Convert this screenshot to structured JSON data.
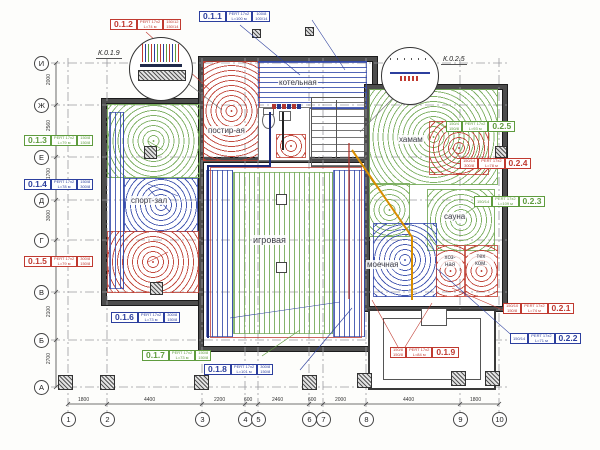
{
  "colors": {
    "red": "#c03a30",
    "blue": "#2c3f9e",
    "green": "#5f9c3e",
    "orange": "#d98e00",
    "wall": "#4d4d4d"
  },
  "grid": {
    "cols": [
      "1",
      "2",
      "3",
      "4",
      "5",
      "6",
      "7",
      "8",
      "9",
      "10"
    ],
    "col_dims": [
      "1800",
      "4400",
      "2200",
      "600",
      "2460",
      "600",
      "2000",
      "4400",
      "1800"
    ],
    "rows": [
      "И",
      "Ж",
      "Е",
      "Д",
      "Г",
      "В",
      "Б",
      "А"
    ],
    "row_dims": [
      "2000",
      "2560",
      "1700",
      "3000",
      "2000",
      "2100",
      "2700"
    ]
  },
  "callouts": {
    "left": "К.0.1.9",
    "right": "К.0.2.5"
  },
  "rooms": {
    "boiler": "котельная",
    "laundry": "постир-ая",
    "gym": "спорт-зал",
    "game": "игровая",
    "hammam": "хамам",
    "sauna": "сауна",
    "wash": "моечная",
    "hoz1": "хоз-",
    "hoz2": "ная",
    "tech1": "тех",
    "tech2": "ком."
  },
  "circuits": {
    "c011": {
      "id": "0.1.1",
      "pipe": "PERT 17x2",
      "len": "L=100 м",
      "v1": "100/8",
      "v2": "100/14"
    },
    "c012": {
      "id": "0.1.2",
      "pipe": "PERT 17x2",
      "len": "L=74 м",
      "v1": "150/12",
      "v2": "150/14"
    },
    "c013": {
      "id": "0.1.3",
      "pipe": "PERT 17x2",
      "len": "L=79 м",
      "v1": "150/8",
      "v2": "150/8"
    },
    "c014": {
      "id": "0.1.4",
      "pipe": "PERT 17x2",
      "len": "L=78 м",
      "v1": "150/8",
      "v2": "300/8"
    },
    "c015": {
      "id": "0.1.5",
      "pipe": "PERT 17x2",
      "len": "L=79 м",
      "v1": "300/8",
      "v2": "150/8"
    },
    "c016": {
      "id": "0.1.6",
      "pipe": "PERT 17x2",
      "len": "L=73 м",
      "v1": "300/8",
      "v2": "150/8"
    },
    "c017": {
      "id": "0.1.7",
      "pipe": "PERT 17x2",
      "len": "L=73 м",
      "v1": "150/8",
      "v2": "150/8"
    },
    "c018": {
      "id": "0.1.8",
      "pipe": "PERT 17x2",
      "len": "L=101 м",
      "v1": "300/8",
      "v2": "150/8"
    },
    "c019": {
      "id": "0.1.9",
      "pipe": "PERT 17x2",
      "len": "L=84 м",
      "v1": "150/8",
      "v2": "150/8"
    },
    "c021": {
      "id": "0.2.1",
      "pipe": "PERT 17x2",
      "len": "L=74 м",
      "v1": "150/10",
      "v2": "150/8"
    },
    "c022": {
      "id": "0.2.2",
      "pipe": "PERT 17x2",
      "len": "L=71 м",
      "v1": "150/14",
      "v2": ""
    },
    "c023": {
      "id": "0.2.3",
      "pipe": "PERT 17x2",
      "len": "L=109 м",
      "v1": "150/14",
      "v2": ""
    },
    "c024": {
      "id": "0.2.4",
      "pipe": "PERT 17x2",
      "len": "L=78 м",
      "v1": "150/14",
      "v2": "300/8"
    },
    "c025": {
      "id": "0.2.5",
      "pipe": "PERT 17x2",
      "len": "L=93 м",
      "v1": "150/4",
      "v2": "150/8"
    }
  }
}
